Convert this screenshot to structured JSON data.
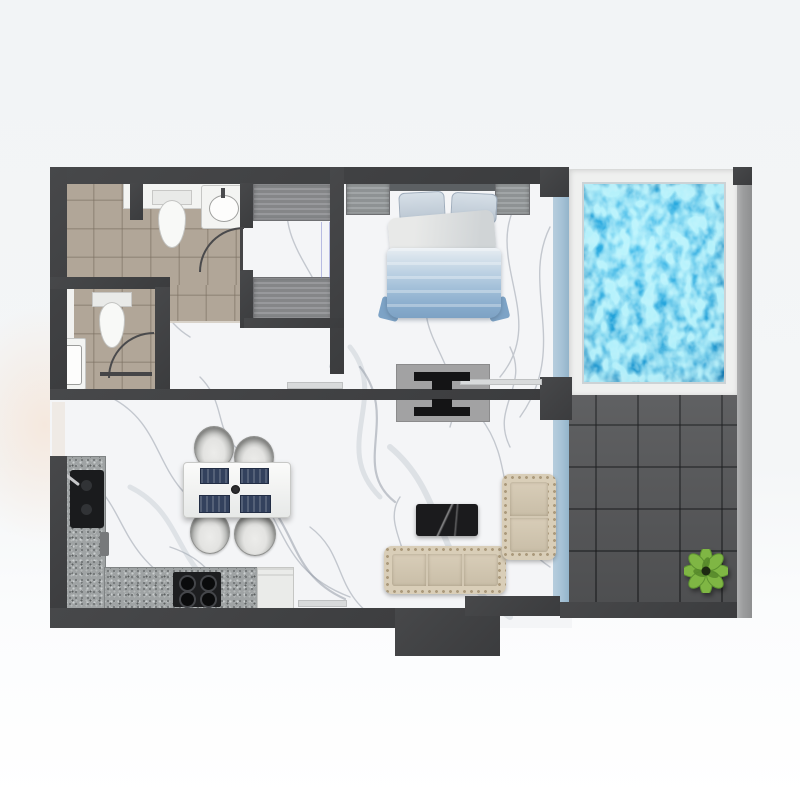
{
  "meta": {
    "description": "3D-rendered apartment floor plan, top-down view, no text labels visible",
    "canvas": {
      "width": 800,
      "height": 800
    }
  },
  "palette": {
    "wall": "#3b3c3e",
    "wall_hi": "#47484a",
    "marble": "#f4f5f7",
    "marble_vein": "#a3aab4",
    "bathroom_tile": "#b1a698",
    "wardrobe_gray": "#909194",
    "glass_blue": "#a6c2d6",
    "pool_water": "#1b9bd4",
    "pool_caustic": "#7fdcff",
    "pool_deck": "#eff0ef",
    "terrace_tile": "#57585a",
    "right_wall_gray": "#9c9d9e",
    "kitchen_counter": "#9fa3a4",
    "appliance_dark": "#1a1b1d",
    "appliance_white": "#eaebe9",
    "sofa_beige": "#d9ceb8",
    "sofa_tuft": "#ab9a7c",
    "bed_blue": "#8fb2d4",
    "bed_linen": "#e3e6e8",
    "dining_navy": "#33415d",
    "furniture_white": "#f2f3f1",
    "coffee_table_black": "#1b1b1d",
    "tv_black": "#141415",
    "console_gray": "#a2a2a3",
    "fixture_white": "#f3f4f2",
    "plant_green": "#7fb644",
    "plant_dark": "#55882a"
  },
  "rooms": [
    {
      "name": "bathroom-main",
      "floor": "beige-tile",
      "items": [
        "vanity-counter",
        "washbasin",
        "toilet",
        "door-swing"
      ]
    },
    {
      "name": "bathroom-small",
      "floor": "beige-tile",
      "items": [
        "toilet",
        "washbasin",
        "shower-strip",
        "door-swing"
      ]
    },
    {
      "name": "hallway-closet",
      "floor": "white-marble",
      "items": [
        "wardrobe-top",
        "wardrobe-bottom",
        "pocket-door-lines"
      ]
    },
    {
      "name": "bedroom",
      "floor": "white-marble",
      "items": [
        "double-bed",
        "pillow-left",
        "pillow-right",
        "duvet-blue",
        "headboard",
        "nightstand-left",
        "nightstand-right",
        "tv-console-double-sided",
        "window-sill"
      ]
    },
    {
      "name": "living-dining",
      "floor": "white-marble",
      "items": [
        "sofa-three-seat",
        "loveseat-two-seat",
        "coffee-table-black-marble",
        "dining-table",
        "dining-chair x4",
        "placemat x4",
        "table-centerpiece"
      ]
    },
    {
      "name": "kitchen",
      "floor": "white-marble",
      "items": [
        "l-shaped-granite-counter",
        "black-sink",
        "faucet",
        "cooktop-four-burner",
        "white-appliance",
        "counter-item"
      ]
    },
    {
      "name": "pool-balcony",
      "floor": "white-deck",
      "items": [
        "swimming-pool-water",
        "glass-wall-upper"
      ]
    },
    {
      "name": "terrace",
      "floor": "dark-gray-tile",
      "items": [
        "potted-plant",
        "glass-wall-lower"
      ]
    }
  ]
}
